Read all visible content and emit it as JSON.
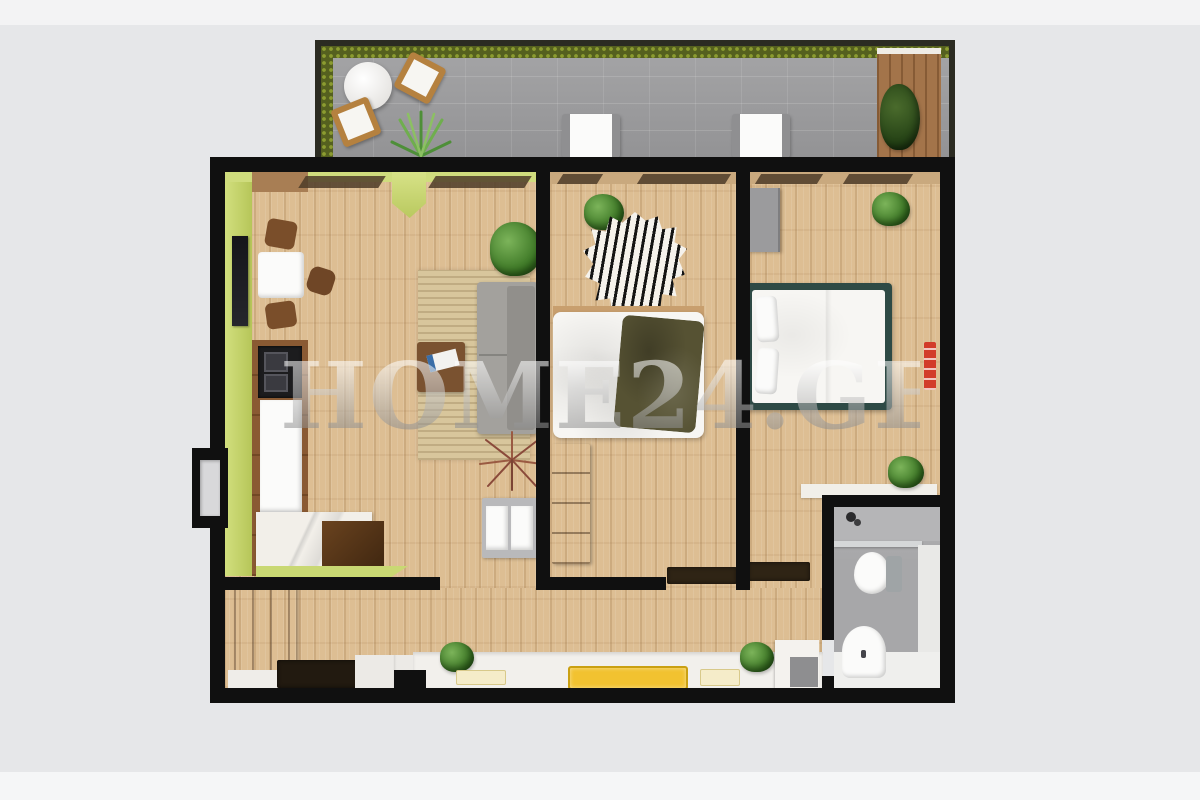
{
  "watermark": {
    "text": "HOME24.GE"
  },
  "palette": {
    "background": "#e6e7e9",
    "wall": "#101010",
    "wood_floor": "#ddbe93",
    "accent_lime": "#c9d873",
    "balcony_tile": "#9c9c9e",
    "hedge": "#55601f",
    "bedding_white": "#f7f6f3",
    "blanket_olive": "#565233",
    "bed_frame_teal": "#2e4a45",
    "sofa_gray": "#a3a19d",
    "counter_marble": "#f2efe9",
    "cabinet_brown": "#8a5a33",
    "tray_yellow": "#f2c230",
    "heater_red": "#d23b2a"
  },
  "scene": {
    "type": "3d-floor-plan-top-view",
    "rooms": [
      "balcony",
      "living-room-kitchen",
      "bedroom-1",
      "bedroom-2",
      "bathroom",
      "hallway",
      "entry-hall"
    ]
  }
}
